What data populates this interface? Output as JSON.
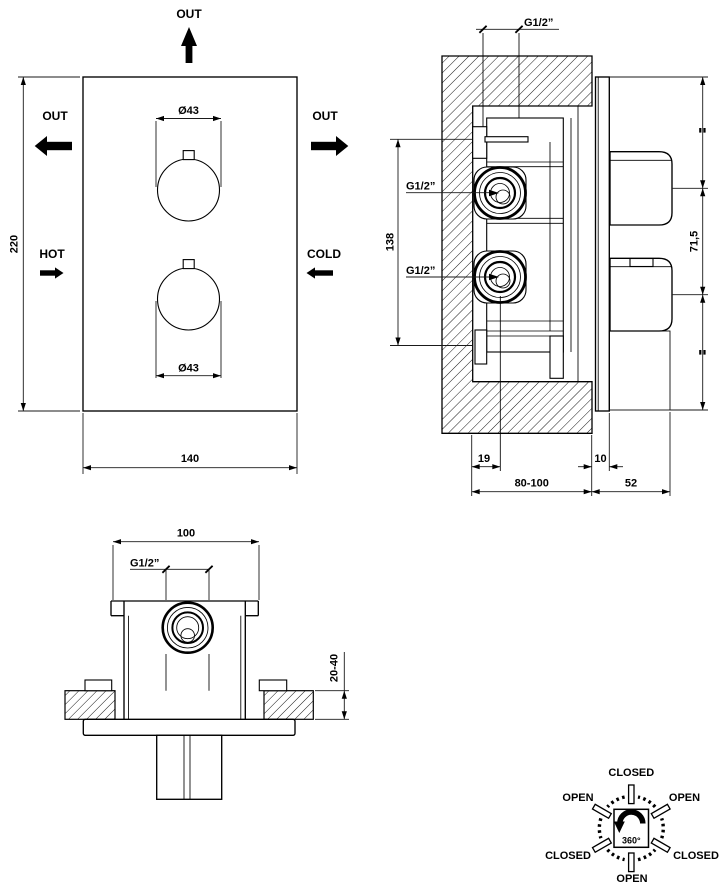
{
  "front_view": {
    "labels": {
      "out_top": "OUT",
      "out_left": "OUT",
      "out_right": "OUT",
      "hot": "HOT",
      "cold": "COLD"
    },
    "dims": {
      "dia_top": "Ø43",
      "dia_bottom": "Ø43",
      "height": "220",
      "width": "140"
    }
  },
  "section_view": {
    "dims": {
      "outlet_top": "G1/2”",
      "inlet_upper": "G1/2”",
      "inlet_lower": "G1/2”",
      "inlet_span": "138",
      "handle_pitch": "71,5",
      "port_depth": "19",
      "plate_thickness": "10",
      "rough_in_depth": "80-100",
      "projection": "52"
    }
  },
  "top_view": {
    "dims": {
      "body_width": "100",
      "outlet": "G1/2”",
      "plaster_depth": "20-40"
    }
  },
  "rotation_diagram": {
    "angle": "360°",
    "positions": {
      "top": "CLOSED",
      "upper_left": "OPEN",
      "upper_right": "OPEN",
      "lower_left": "CLOSED",
      "lower_right": "CLOSED",
      "bottom": "OPEN"
    }
  },
  "colors": {
    "line": "#000000",
    "background": "#ffffff"
  }
}
